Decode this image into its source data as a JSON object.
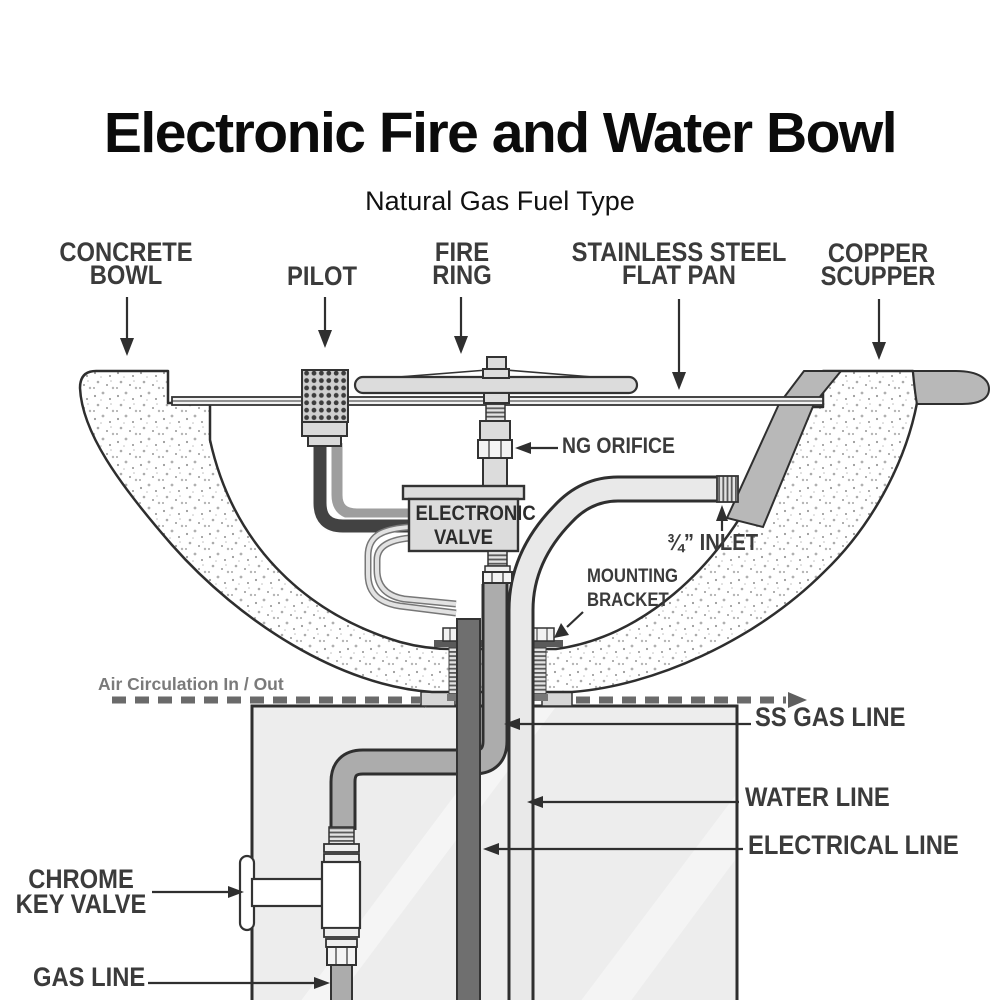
{
  "title": "Electronic Fire and Water Bowl",
  "subtitle": "Natural Gas Fuel Type",
  "callouts": {
    "concrete_bowl": "CONCRETE\nBOWL",
    "pilot": "PILOT",
    "fire_ring": "FIRE\nRING",
    "flat_pan": "STAINLESS STEEL\nFLAT PAN",
    "copper_scupper": "COPPER\nSCUPPER",
    "ng_orifice": "NG ORIFICE",
    "electronic_valve": "ELECTRONIC\nVALVE",
    "inlet": "¾” INLET",
    "mounting_bracket": "MOUNTING\nBRACKET",
    "air_circulation": "Air Circulation In / Out",
    "ss_gas_line": "SS GAS LINE",
    "water_line": "WATER LINE",
    "electrical_line": "ELECTRICAL  LINE",
    "chrome_key_valve": "CHROME\nKEY VALVE",
    "gas_line": "GAS LINE"
  },
  "colors": {
    "label_text": "#3b3b3b",
    "air_label_text": "#7a7a7a",
    "outline": "#2f2f2f",
    "scupper_gray": "#b8b8b8",
    "ss_pipe_gray": "#acacac",
    "water_pipe_gray": "#e9e9e9",
    "electrical_gray": "#6f6f6f",
    "pedestal_gray": "#ededed",
    "valve_fill": "#dcdcdc"
  }
}
